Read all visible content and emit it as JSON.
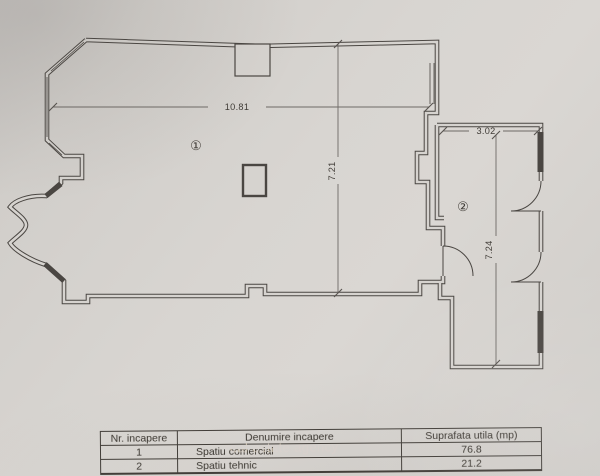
{
  "plan": {
    "room_markers": {
      "room1": "①",
      "room2": "②"
    },
    "dimensions": {
      "main_width": "10.81",
      "main_height": "7.21",
      "room2_width": "3.02",
      "room2_height": "7.24"
    }
  },
  "watermark": {
    "text": "real estate agency"
  },
  "table": {
    "headers": [
      "Nr. incapere",
      "Denumire incapere",
      "Suprafata utila (mp)"
    ],
    "rows": [
      {
        "nr": "1",
        "denumire": "Spatiu comercial",
        "suprafata": "76.8"
      },
      {
        "nr": "2",
        "denumire": "Spatiu tehnic",
        "suprafata": "21.2"
      }
    ]
  },
  "colors": {
    "paper": "#d6d3cf",
    "ink": "#4a4642",
    "dim_line": "#6e6a66",
    "watermark": "#d9cdb6"
  }
}
